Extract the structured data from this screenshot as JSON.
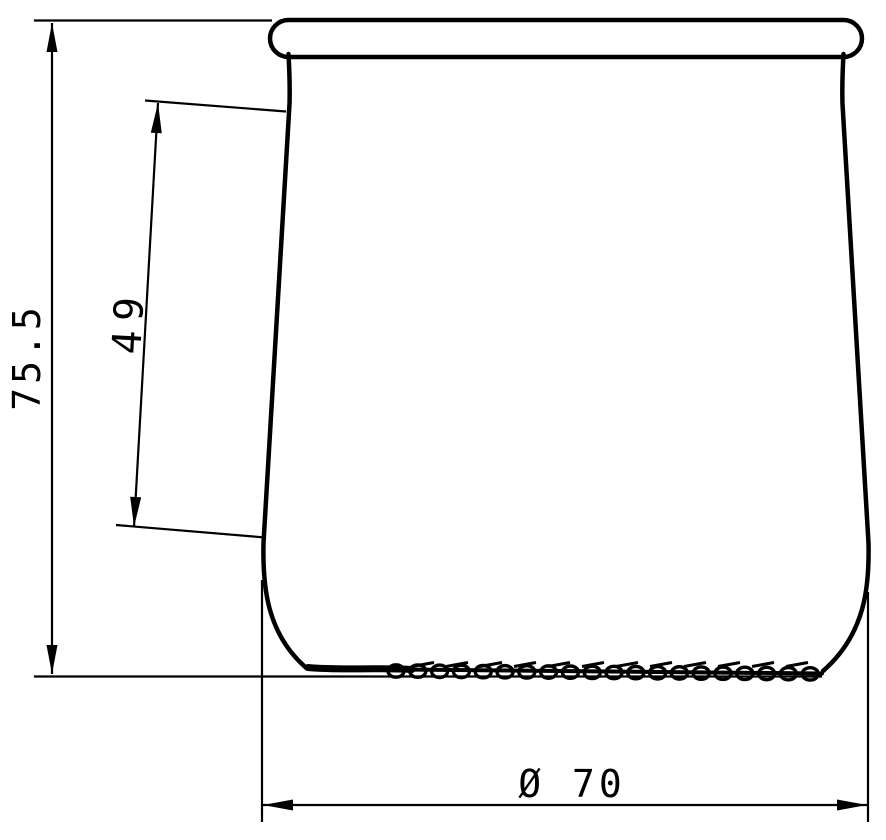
{
  "drawing": {
    "type": "technical-drawing",
    "subject": "glass-yogurt-jar-profile",
    "background_color": "#ffffff",
    "line_color": "#000000",
    "dimensions": {
      "overall_height": {
        "label": "75.5",
        "value_mm": 75.5,
        "orientation": "vertical-left"
      },
      "side_wall_length": {
        "label": "49",
        "value_mm": 49,
        "orientation": "aligned-with-tapered-wall"
      },
      "base_diameter": {
        "label": "Ø 70",
        "value_mm": 70,
        "orientation": "horizontal-bottom"
      }
    }
  }
}
